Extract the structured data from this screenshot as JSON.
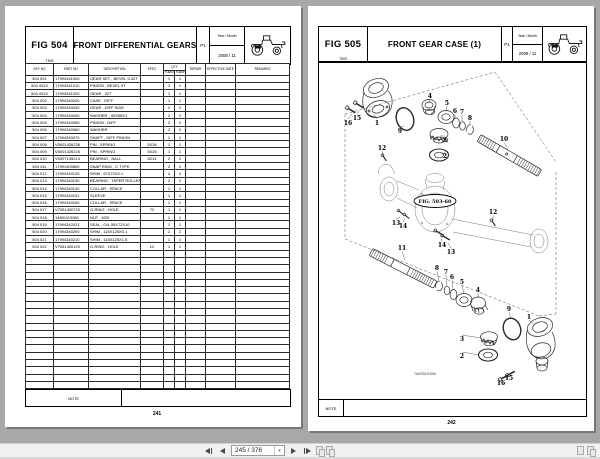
{
  "viewer": {
    "background_color": "#a8a8a8",
    "toolbar": {
      "page_field": "245 / 376",
      "icon_names": [
        "first-page",
        "previous-page",
        "page-number-dropdown",
        "next-page",
        "last-page",
        "facing-pages-view",
        "facing-pages-continuous-view",
        "page-thumb",
        "page-thumb-double"
      ]
    }
  },
  "left_page": {
    "fig": "FIG 504",
    "model": "T503",
    "title": "FRONT DIFFERENTIAL GEARS",
    "sheet": "P1",
    "year_label": "Year / Month",
    "year_value": "2008 / 11",
    "columns": {
      "key_no": "KEY NO",
      "part_no": "PART NO",
      "description": "DESCRIPTION",
      "spec": "SPEC",
      "qty": "QTY",
      "qty_sub1": "THENO",
      "qty_sub2": "THENP",
      "repair": "REPAIR",
      "effective_date": "EFFECTIVE DATE",
      "remarks": "REMARKS"
    },
    "rows": [
      [
        "504 001",
        "17994341000",
        "GEAR SET , BEVEL 9-32T",
        "",
        "1",
        "1"
      ],
      [
        "504 0010",
        "17994341010",
        "PINION , BEVEL 9T",
        "",
        "1",
        "1"
      ],
      [
        "504 0010",
        "17994341020",
        "GEAR , 32T",
        "",
        "1",
        "1"
      ],
      [
        "504 002",
        "17994340020",
        "CASE , DIFF",
        "",
        "1",
        "1"
      ],
      [
        "504 003",
        "17994340030",
        "GEAR , DIFF SIDE",
        "",
        "2",
        "2"
      ],
      [
        "504 004",
        "17994340040",
        "WASHER , 40X58X1",
        "",
        "2",
        "2"
      ],
      [
        "504 005",
        "17994340050",
        "PINION , DIFF",
        "",
        "2",
        "2"
      ],
      [
        "504 006",
        "17994340060",
        "WASHER",
        "",
        "2",
        "2"
      ],
      [
        "504 007",
        "17994340070",
        "SHAFT , DIFF PINION",
        "",
        "1",
        "1"
      ],
      [
        "504 008",
        "V5001426236",
        "PIN , SPRING",
        "5X36",
        "1",
        "1"
      ],
      [
        "504 009",
        "V5001426226",
        "PIN , SPRING",
        "5X26",
        "1",
        "1"
      ],
      [
        "504 010",
        "V5007135214",
        "BEARING , BALL",
        "6214",
        "2",
        "2"
      ],
      [
        "504 011",
        "17991400800",
        "SNAP RING , C TYPE",
        "",
        "2",
        "2"
      ],
      [
        "504 012",
        "17994340120",
        "SHIM , 67X72X0.1",
        "",
        "4",
        "4"
      ],
      [
        "504 013",
        "17994340130",
        "BEARING , TAPER ROLLER",
        "",
        "2",
        "2"
      ],
      [
        "504 014",
        "17994340140",
        "COLLAR , SPACE",
        "",
        "1",
        "1"
      ],
      [
        "504 015",
        "17994340151",
        "SLEEVE",
        "",
        "1",
        "1"
      ],
      [
        "504 016",
        "17994340160",
        "COLLAR , SPACE",
        "",
        "1",
        "1"
      ],
      [
        "504 017",
        "V7051400720",
        "O-RING , HOLE",
        "72",
        "1",
        "1"
      ],
      [
        "504 018",
        "14891110080",
        "NUT , M20",
        "",
        "1",
        "1"
      ],
      [
        "504 019",
        "17994342021",
        "SEAL , OIL 55X72X10",
        "",
        "1",
        "1"
      ],
      [
        "504 020",
        "17994340200",
        "SHIM , 115X125X0.1",
        "",
        "2",
        "2"
      ],
      [
        "504 021",
        "17994340210",
        "SHIM , 115X125X1.5",
        "",
        "1",
        "1"
      ],
      [
        "504 022",
        "V7051400120",
        "O-RING , HOLE",
        "12",
        "1",
        "1"
      ]
    ],
    "empty_rows": 19,
    "note_label": "NOTE",
    "page_number": "241"
  },
  "right_page": {
    "fig": "FIG 505",
    "model": "T503",
    "title": "FRONT GEAR CASE (1)",
    "sheet": "P1",
    "year_label": "Year / Month",
    "year_value": "2008 / 11",
    "diagram": {
      "ref_label": "FIG. 503-60",
      "footnote": "TA0/TA5-E/59A",
      "callouts": [
        {
          "n": "16",
          "x": 29,
          "y": 63,
          "tx": 33,
          "ty": 52
        },
        {
          "n": "15",
          "x": 38,
          "y": 58,
          "tx": 40,
          "ty": 49
        },
        {
          "n": "1",
          "x": 58,
          "y": 63,
          "tx": 55,
          "ty": 52
        },
        {
          "n": "9",
          "x": 81,
          "y": 71,
          "tx": 85,
          "ty": 64
        },
        {
          "n": "4",
          "x": 111,
          "y": 36,
          "tx": 110,
          "ty": 41
        },
        {
          "n": "5",
          "x": 128,
          "y": 43,
          "tx": 127,
          "ty": 50
        },
        {
          "n": "6",
          "x": 136,
          "y": 51,
          "tx": 136,
          "ty": 57
        },
        {
          "n": "7",
          "x": 143,
          "y": 52,
          "tx": 143,
          "ty": 60
        },
        {
          "n": "8",
          "x": 151,
          "y": 58,
          "tx": 151,
          "ty": 63
        },
        {
          "n": "3",
          "x": 126,
          "y": 80,
          "tx": 121,
          "ty": 74
        },
        {
          "n": "2",
          "x": 126,
          "y": 96,
          "tx": 122,
          "ty": 93
        },
        {
          "n": "10",
          "x": 185,
          "y": 79,
          "tx": 189,
          "ty": 87
        },
        {
          "n": "12",
          "x": 63,
          "y": 88,
          "tx": 64,
          "ty": 94
        },
        {
          "n": "12",
          "x": 174,
          "y": 152,
          "tx": 174,
          "ty": 158
        },
        {
          "n": "13",
          "x": 77,
          "y": 163,
          "tx": 81,
          "ty": 155
        },
        {
          "n": "14",
          "x": 84,
          "y": 166,
          "tx": 86,
          "ty": 157
        },
        {
          "n": "11",
          "x": 83,
          "y": 188,
          "tx": 86,
          "ty": 198
        },
        {
          "n": "14",
          "x": 123,
          "y": 185,
          "tx": 122,
          "ty": 176
        },
        {
          "n": "13",
          "x": 132,
          "y": 192,
          "tx": 129,
          "ty": 181
        },
        {
          "n": "8",
          "x": 118,
          "y": 208,
          "tx": 120,
          "ty": 219
        },
        {
          "n": "7",
          "x": 127,
          "y": 212,
          "tx": 128,
          "ty": 224
        },
        {
          "n": "6",
          "x": 133,
          "y": 217,
          "tx": 134,
          "ty": 228
        },
        {
          "n": "5",
          "x": 143,
          "y": 222,
          "tx": 145,
          "ty": 232
        },
        {
          "n": "4",
          "x": 159,
          "y": 230,
          "tx": 159,
          "ty": 236
        },
        {
          "n": "9",
          "x": 190,
          "y": 249,
          "tx": 192,
          "ty": 257
        },
        {
          "n": "1",
          "x": 210,
          "y": 257,
          "tx": 215,
          "ty": 262
        },
        {
          "n": "3",
          "x": 143,
          "y": 279,
          "tx": 162,
          "ty": 276
        },
        {
          "n": "2",
          "x": 143,
          "y": 296,
          "tx": 160,
          "ty": 293
        },
        {
          "n": "16",
          "x": 182,
          "y": 323,
          "tx": 184,
          "ty": 315
        },
        {
          "n": "15",
          "x": 190,
          "y": 318,
          "tx": 191,
          "ty": 311
        }
      ]
    },
    "note_label": "NOTE",
    "page_number": "242"
  }
}
